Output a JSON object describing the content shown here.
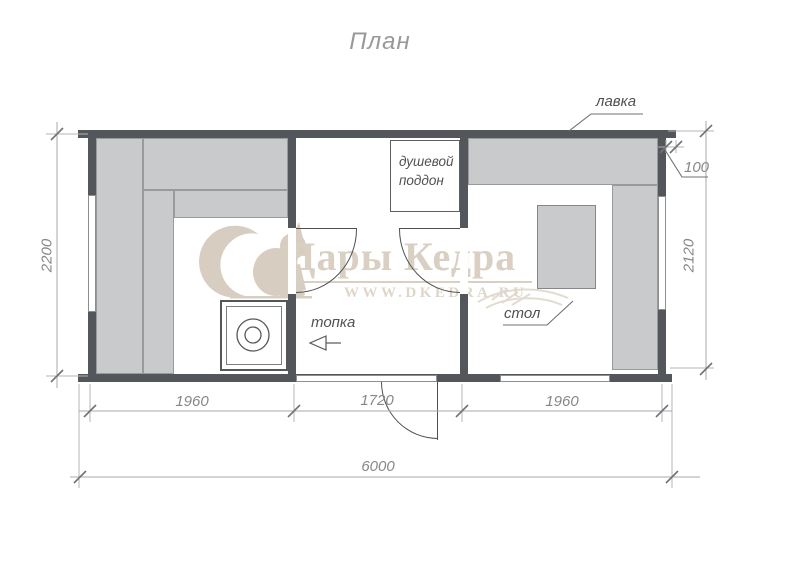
{
  "title": "План",
  "watermark": {
    "brand": "Дары Кедра",
    "url": "WWW.DKEDRA.RU"
  },
  "labels": {
    "bench": "лавка",
    "shower_tray": "душевой поддон",
    "firebox": "топка",
    "table": "стол"
  },
  "dimensions": {
    "left_height": "2200",
    "right_height": "2120",
    "overhang": "100",
    "segments": [
      "1960",
      "1720",
      "1960"
    ],
    "total": "6000"
  },
  "colors": {
    "wall": "#53565a",
    "bench": "#c9cacc",
    "dim_line": "#a8aaac",
    "watermark": "#d9d0c3"
  }
}
